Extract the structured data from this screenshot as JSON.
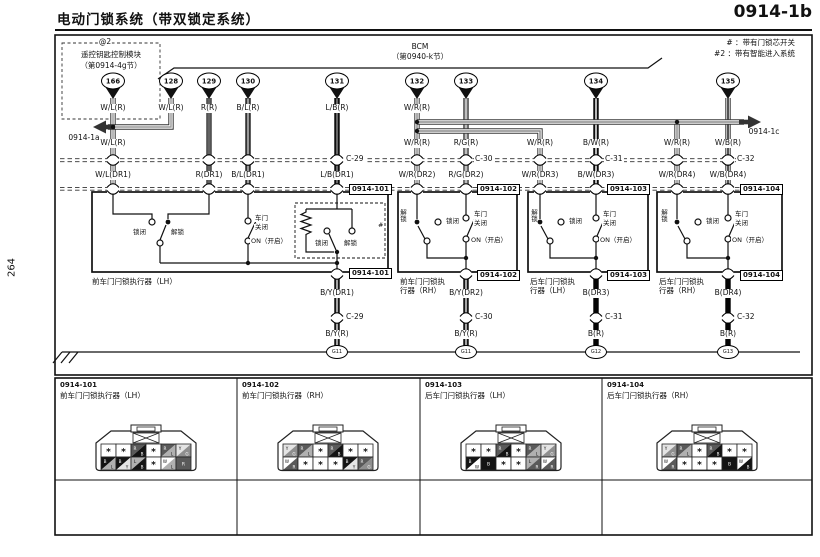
{
  "header": {
    "title": "电动门锁系统（带双锁定系统）",
    "page_code": "0914-1b",
    "side_page_number": "264"
  },
  "legend": {
    "line1": "# ：带有门锁芯开关",
    "line2": "#2 ：带有智能进入系统"
  },
  "refs": {
    "left": "0914-1a",
    "right": "0914-1c"
  },
  "modules": {
    "remote": {
      "badge": "@2",
      "name": "遥控钥匙控制模块",
      "section": "（第0914-4g节）",
      "pin": "166"
    },
    "bcm": {
      "name": "BCM",
      "section": "（第0940-k节）",
      "pins": [
        "128",
        "129",
        "130",
        "131",
        "132",
        "133",
        "134",
        "135"
      ]
    }
  },
  "wire_labels": {
    "row1": [
      "W/L(R)",
      "W/L(R)",
      "R(R)",
      "B/L(R)",
      "L/B(R)",
      "W/R(R)"
    ],
    "row2": [
      "W/L(R)",
      "W/R(R)",
      "R/G(R)",
      "W/R(R)",
      "B/W(R)",
      "W/R(R)",
      "W/B(R)"
    ],
    "row3": [
      "W/L(DR1)",
      "R(DR1)",
      "B/L(DR1)",
      "L/B(DR1)",
      "W/R(DR2)",
      "R/G(DR2)",
      "W/R(DR3)",
      "B/W(DR3)",
      "W/R(DR4)",
      "W/B(DR4)"
    ],
    "connectors_top": [
      "C-29",
      "C-30",
      "C-31",
      "C-32"
    ],
    "row4": [
      "B/Y(DR1)",
      "B/Y(DR2)",
      "B(DR3)",
      "B(DR4)"
    ],
    "connectors_bottom": [
      "C-29",
      "C-30",
      "C-31",
      "C-32"
    ],
    "row5": [
      "B/Y(R)",
      "B/Y(R)",
      "B(R)",
      "B(R)"
    ],
    "grounds": [
      "G11",
      "G11",
      "G12",
      "G13"
    ]
  },
  "actuators": [
    {
      "tag": "0914-101",
      "caption": "前车门闩锁执行器（LH）",
      "labels": {
        "lock": "锁闭",
        "unlock": "解锁",
        "door": "车门",
        "closed": "关闭",
        "on": "ON（开启）",
        "key_lock": "锁闭",
        "key_unlock": "解锁",
        "hash": "#"
      }
    },
    {
      "tag": "0914-102",
      "caption_line1": "前车门闩锁执",
      "caption_line2": "行器（RH）",
      "labels": {
        "unlock": "解锁",
        "lock": "锁闭",
        "door": "车门",
        "closed": "关闭",
        "on": "ON（开启）"
      }
    },
    {
      "tag": "0914-103",
      "caption_line1": "后车门闩锁执",
      "caption_line2": "行器（LH）",
      "labels": {
        "unlock": "解锁",
        "lock": "锁闭",
        "door": "车门",
        "closed": "关闭",
        "on": "ON（开启）"
      }
    },
    {
      "tag": "0914-104",
      "caption_line1": "后车门闩锁执",
      "caption_line2": "行器（RH）",
      "labels": {
        "unlock": "解锁",
        "lock": "锁闭",
        "door": "车门",
        "closed": "关闭",
        "on": "ON（开启）"
      }
    }
  ],
  "pinout_panels": [
    {
      "code": "0914-101",
      "name": "前车门闩锁执行器（LH）",
      "rows": [
        [
          "*",
          "*",
          "R/B",
          "*",
          "R/L",
          "Y/G"
        ],
        [
          "B/L",
          "B/Y",
          "L/B",
          "*",
          "W/L",
          "R"
        ]
      ]
    },
    {
      "code": "0914-102",
      "name": "前车门闩锁执行器（RH）",
      "rows": [
        [
          "Y/G",
          "R/L",
          "*",
          "R/B",
          "*",
          "*"
        ],
        [
          "W/R",
          "*",
          "*",
          "*",
          "B/Y",
          "R/G"
        ]
      ]
    },
    {
      "code": "0914-103",
      "name": "后车门闩锁执行器（LH）",
      "rows": [
        [
          "*",
          "*",
          "R/B",
          "*",
          "R/L",
          "Y/G"
        ],
        [
          "B/W",
          "B",
          "*",
          "*",
          "L/R",
          "W/R"
        ]
      ]
    },
    {
      "code": "0914-104",
      "name": "后车门闩锁执行器（RH）",
      "rows": [
        [
          "Y/G",
          "R/L",
          "*",
          "R/B",
          "*",
          "*"
        ],
        [
          "W/R",
          "*",
          "*",
          "*",
          "B",
          "W/B"
        ]
      ]
    }
  ],
  "colors": {
    "W": "#ffffff",
    "B": "#141414",
    "R": "#5a5a5a",
    "L": "#b0b0b0",
    "Y": "#e4e4e4",
    "G": "#8f8f8f"
  }
}
